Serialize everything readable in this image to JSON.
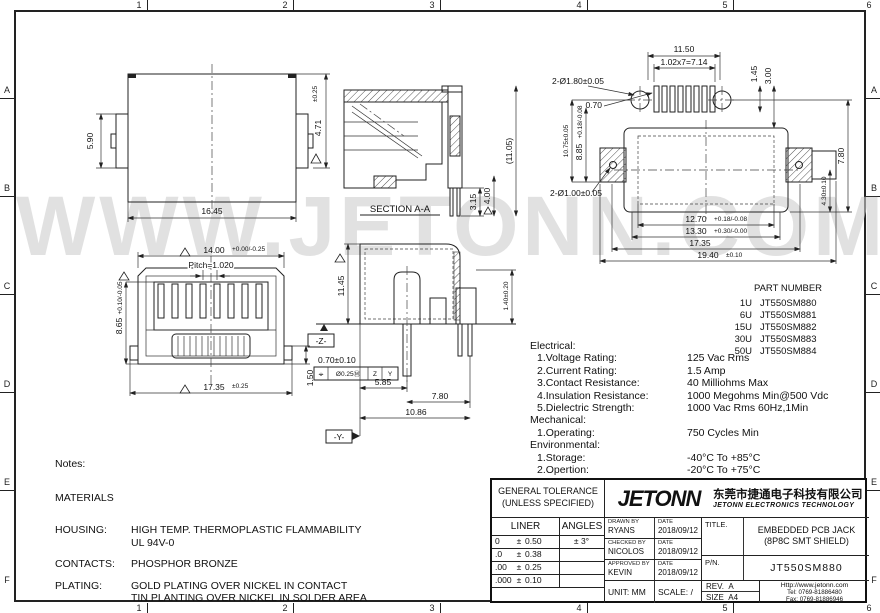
{
  "watermark": "WWW.JETONN.COM",
  "frame": {
    "cols": [
      "1",
      "2",
      "3",
      "4",
      "5",
      "6"
    ],
    "rows": [
      "A",
      "B",
      "C",
      "D",
      "E",
      "F"
    ]
  },
  "views": {
    "front": {
      "dim_width": "16.45",
      "dim_side": "5.90",
      "dim_height": "4.71",
      "dim_height_tol": "±0.25"
    },
    "section": {
      "label": "SECTION A-A",
      "dim_pin1": "3.15",
      "dim_pin2": "4.00",
      "dim_total": "(11.05)"
    },
    "footprint": {
      "dim_holes_top": "2-Ø1.80±0.05",
      "dim_width_top": "11.50",
      "dim_pitch_row": "1.02x7=7.14",
      "dim_pad": "0.70",
      "dim_gap1": "1.45",
      "dim_gap2": "3.00",
      "dim_left1": "10.75±0.05",
      "dim_left2": "8.85",
      "dim_left2_tol": "+0.18/-0.08",
      "dim_right": "7.80",
      "dim_holes_side": "2-Ø1.00±0.05",
      "dim_b1": "12.70",
      "dim_b1_tol": "+0.18/-0.08",
      "dim_b2": "13.30",
      "dim_b2_tol": "+0.30/-0.00",
      "dim_b3": "17.35",
      "dim_b4": "19.40",
      "dim_b4_tol": "±0.10",
      "dim_side_h": "4.30±0.10"
    },
    "front2": {
      "dim_top": "14.00",
      "dim_top_tol": "+0.00/-0.25",
      "pitch": "Pitch=1.020",
      "dim_left": "8.65",
      "dim_left_tol": "+0.10/-0.05",
      "dim_bottom": "17.35",
      "dim_bottom_tol": "±0.25",
      "dim_tab": "1.50"
    },
    "side": {
      "dim_height": "11.45",
      "dim_pin": "1.40±0.20",
      "dim_pin2": "0.70±0.10",
      "fcf_symbol": "⌖",
      "fcf_tol": "Ø0.25Ⓜ",
      "fcf_d1": "Z",
      "fcf_d2": "Y",
      "dim_l1": "5.85",
      "dim_l2": "7.80",
      "dim_l3": "10.86",
      "datum_z": "-Z-",
      "datum_y": "-Y-"
    }
  },
  "part_table": {
    "header": "PART NUMBER",
    "rows": [
      {
        "qty": "1U",
        "pn": "JT550SM880"
      },
      {
        "qty": "6U",
        "pn": "JT550SM881"
      },
      {
        "qty": "15U",
        "pn": "JT550SM882"
      },
      {
        "qty": "30U",
        "pn": "JT550SM883"
      },
      {
        "qty": "50U",
        "pn": "JT550SM884"
      }
    ]
  },
  "specs": {
    "electrical_title": "Electrical:",
    "electrical": [
      {
        "label": "1.Voltage Rating:",
        "value": "125 Vac Rms"
      },
      {
        "label": "2.Current Rating:",
        "value": "1.5 Amp"
      },
      {
        "label": "3.Contact Resistance:",
        "value": "40 Milliohms Max"
      },
      {
        "label": "4.Insulation Resistance:",
        "value": "1000 Megohms Min@500 Vdc"
      },
      {
        "label": "5.Dielectric Strength:",
        "value": "1000 Vac Rms 60Hz,1Min"
      }
    ],
    "mechanical_title": "Mechanical:",
    "mechanical": [
      {
        "label": "1.Operating:",
        "value": "750 Cycles Min"
      }
    ],
    "environmental_title": "Environmental:",
    "environmental": [
      {
        "label": "1.Storage:",
        "value": "-40°C To +85°C"
      },
      {
        "label": "2.Opertion:",
        "value": "-20°C To +75°C"
      }
    ],
    "mates": "Mates With Modular Plug Conforming To FCC Part 68,Subpart F"
  },
  "notes": {
    "title": "Notes:",
    "materials_title": "MATERIALS",
    "items": [
      {
        "label": "HOUSING:",
        "line1": "HIGH TEMP. THERMOPLASTIC FLAMMABILITY",
        "line2": "UL 94V-0"
      },
      {
        "label": "CONTACTS:",
        "line1": "PHOSPHOR BRONZE",
        "line2": ""
      },
      {
        "label": "PLATING:",
        "line1": "GOLD PLATING OVER NICKEL IN CONTACT",
        "line2": "TIN PLANTING OVER NICKEL IN SOLDER AREA"
      },
      {
        "label": "SHIELD:",
        "line1": "BRASS PLATING NICKEL ALLOY",
        "line2": ""
      }
    ]
  },
  "titleblock": {
    "tolerance": {
      "header1": "GENERAL TOLERANCE",
      "header2": "(UNLESS SPECIFIED)",
      "col_liner": "LINER",
      "col_angles": "ANGLES",
      "rows": [
        {
          "dec": "0",
          "pm": "±",
          "tol": "0.50",
          "angle": "± 3°"
        },
        {
          "dec": ".0",
          "pm": "±",
          "tol": "0.38",
          "angle": ""
        },
        {
          "dec": ".00",
          "pm": "±",
          "tol": "0.25",
          "angle": ""
        },
        {
          "dec": ".000",
          "pm": "±",
          "tol": "0.10",
          "angle": ""
        }
      ]
    },
    "logo": "JETONN",
    "company_cn": "东莞市捷通电子科技有限公司",
    "company_en": "JETONN ELECTRONICS TECHNOLOGY",
    "drawn_label": "DRAWN BY",
    "drawn_name": "RYANS",
    "checked_label": "CHECKED BY",
    "checked_name": "NICOLOS",
    "approved_label": "APPROVED BY",
    "approved_name": "KEVIN",
    "date_label": "DATE",
    "drawn_date": "2018/09/12",
    "checked_date": "2018/09/12",
    "approved_date": "2018/09/12",
    "unit_label": "UNIT:",
    "unit_value": "MM",
    "scale_label": "SCALE:",
    "scale_value": "/",
    "title_label": "TITLE.",
    "title_line1": "EMBEDDED PCB JACK",
    "title_line2": "(8P8C SMT SHIELD)",
    "pn_label": "P/N.",
    "pn_value": "JT550SM880",
    "rev_label": "REV.",
    "rev_value": "A",
    "size_label": "SIZE",
    "size_value": "A4",
    "web": "Http://www.jetonn.com",
    "tel": "Tel:  0769-81886480",
    "fax": "Fax: 0769-81886946"
  }
}
